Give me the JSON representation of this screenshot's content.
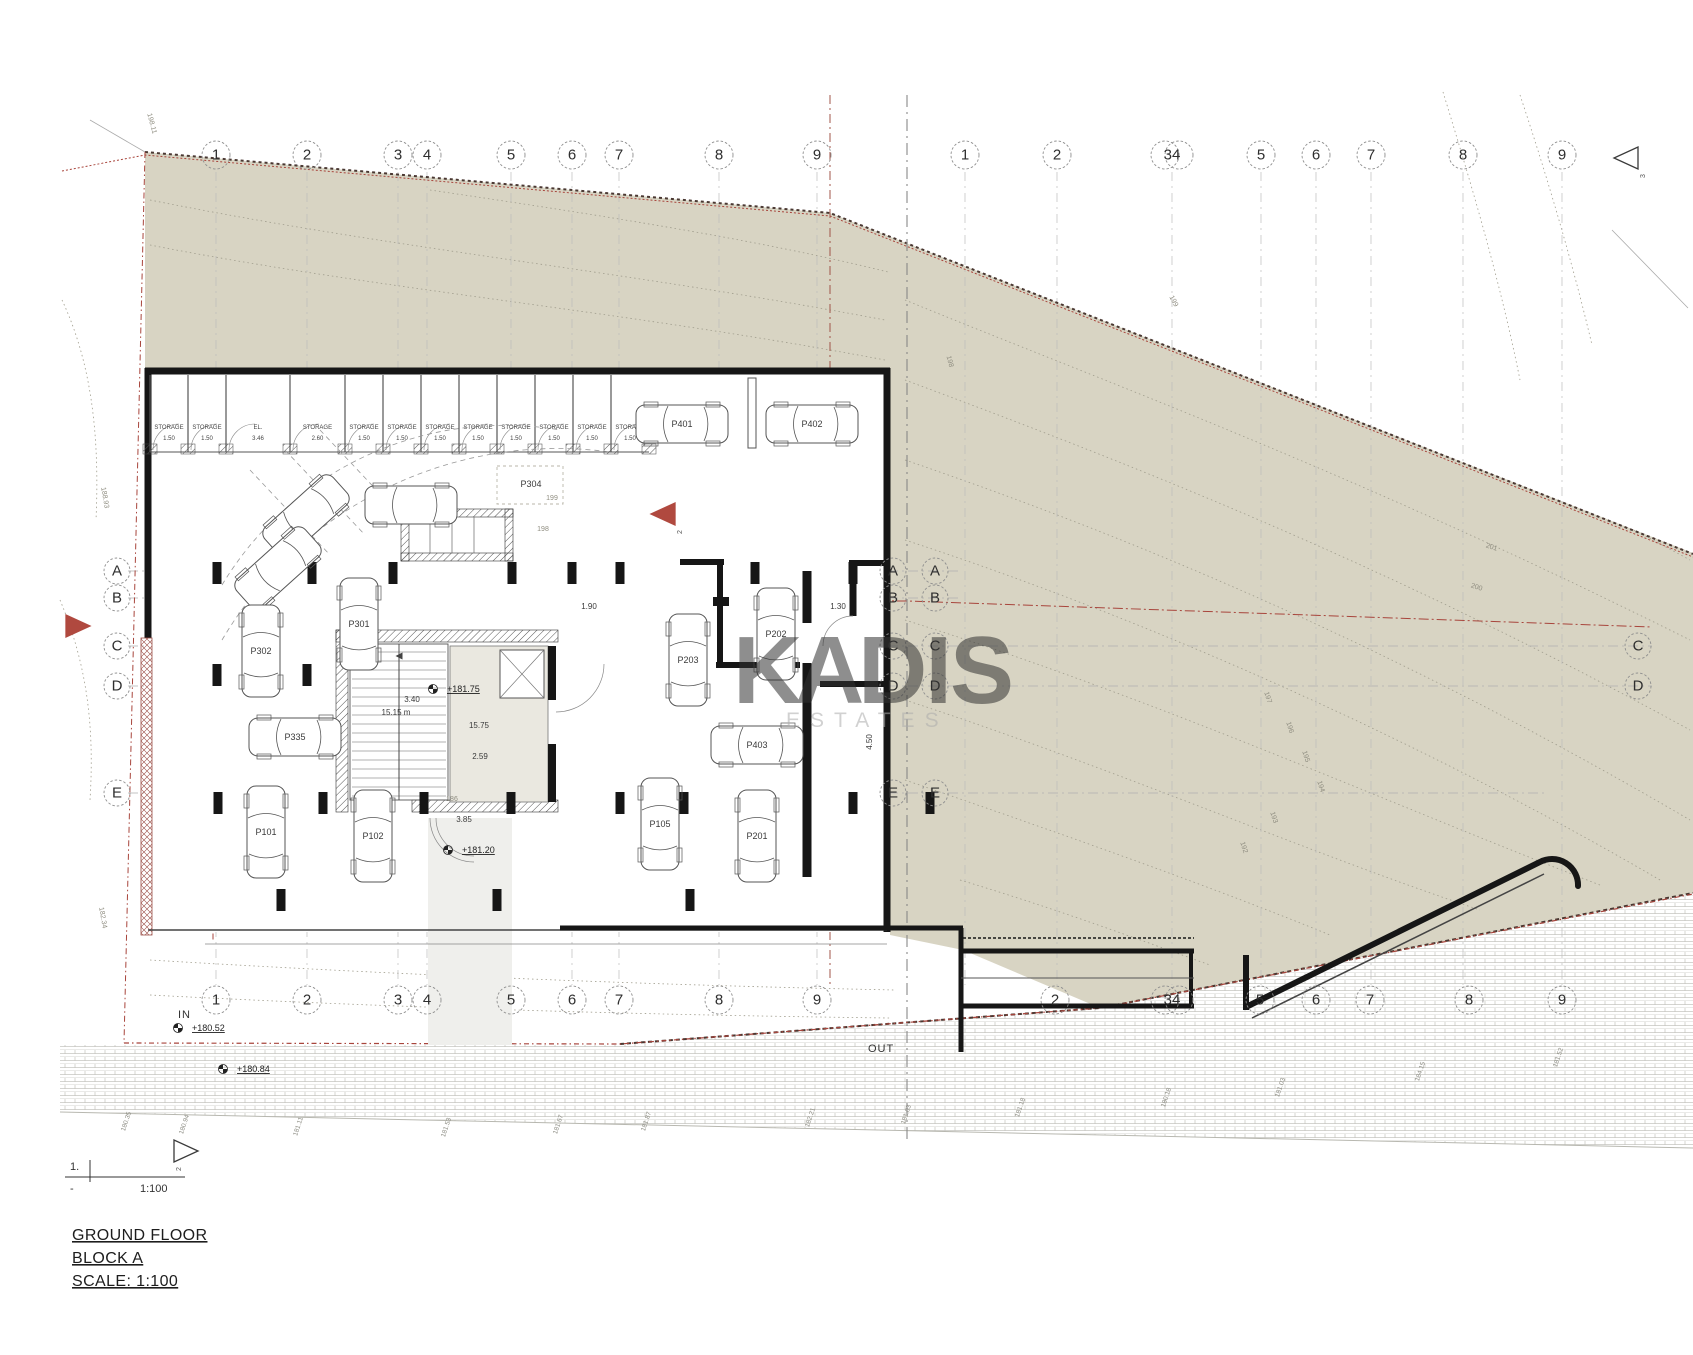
{
  "page": {
    "title_line1": "GROUND FLOOR",
    "title_line2": "BLOCK A",
    "title_line3": "SCALE: 1:100",
    "sheet_no": "1.",
    "sheet_dash": "-",
    "sheet_scale": "1:100"
  },
  "watermark": {
    "k": "K",
    "a": "A",
    "dis": "DIS",
    "subtitle": "ESTATES",
    "gray": "#b5b5b5",
    "tan": "#d7c7a0"
  },
  "flow": {
    "in_label": "IN",
    "out_label": "OUT"
  },
  "colors": {
    "terrain": "#d8d4c3",
    "wall": "#161616",
    "boundary_red": "#a8453c",
    "line": "#555555"
  },
  "grid": {
    "bubble_radius": 14,
    "top_y": 155,
    "bottom_y": 1000,
    "top": [
      {
        "t": "1",
        "x": 216
      },
      {
        "t": "2",
        "x": 307
      },
      {
        "t": "3",
        "x": 398
      },
      {
        "t": "4",
        "x": 427
      },
      {
        "t": "5",
        "x": 511
      },
      {
        "t": "6",
        "x": 572
      },
      {
        "t": "7",
        "x": 619
      },
      {
        "t": "8",
        "x": 719
      },
      {
        "t": "9",
        "x": 817
      },
      {
        "t": "1",
        "x": 965
      },
      {
        "t": "2",
        "x": 1057
      },
      {
        "t": "34",
        "x": 1172,
        "d": true
      },
      {
        "t": "5",
        "x": 1261
      },
      {
        "t": "6",
        "x": 1316
      },
      {
        "t": "7",
        "x": 1371
      },
      {
        "t": "8",
        "x": 1463
      },
      {
        "t": "9",
        "x": 1562
      }
    ],
    "bottom": [
      {
        "t": "1",
        "x": 216
      },
      {
        "t": "2",
        "x": 307
      },
      {
        "t": "3",
        "x": 398
      },
      {
        "t": "4",
        "x": 427
      },
      {
        "t": "5",
        "x": 511
      },
      {
        "t": "6",
        "x": 572
      },
      {
        "t": "7",
        "x": 619
      },
      {
        "t": "8",
        "x": 719
      },
      {
        "t": "9",
        "x": 817
      },
      {
        "t": "2",
        "x": 1055
      },
      {
        "t": "34",
        "x": 1172,
        "d": true
      },
      {
        "t": "5",
        "x": 1260
      },
      {
        "t": "6",
        "x": 1316
      },
      {
        "t": "7",
        "x": 1370
      },
      {
        "t": "8",
        "x": 1469
      },
      {
        "t": "9",
        "x": 1562
      }
    ],
    "letters": [
      {
        "t": "A",
        "x": 117,
        "y": 571
      },
      {
        "t": "B",
        "x": 117,
        "y": 598
      },
      {
        "t": "C",
        "x": 117,
        "y": 646
      },
      {
        "t": "D",
        "x": 117,
        "y": 686
      },
      {
        "t": "E",
        "x": 117,
        "y": 793
      },
      {
        "t": "A",
        "x": 893,
        "y": 571
      },
      {
        "t": "A",
        "x": 935,
        "y": 571
      },
      {
        "t": "B",
        "x": 893,
        "y": 598
      },
      {
        "t": "B",
        "x": 935,
        "y": 598
      },
      {
        "t": "C",
        "x": 893,
        "y": 646
      },
      {
        "t": "C",
        "x": 935,
        "y": 646
      },
      {
        "t": "D",
        "x": 893,
        "y": 686
      },
      {
        "t": "D",
        "x": 935,
        "y": 686
      },
      {
        "t": "E",
        "x": 893,
        "y": 793
      },
      {
        "t": "E",
        "x": 935,
        "y": 793
      },
      {
        "t": "C",
        "x": 1638,
        "y": 646
      },
      {
        "t": "D",
        "x": 1638,
        "y": 686
      }
    ]
  },
  "triangles": [
    {
      "t": "3",
      "x": 1625,
      "y": 158,
      "dir": "left",
      "c": "#3a3a3a",
      "fill": "none"
    },
    {
      "t": "2",
      "x": 662,
      "y": 514,
      "dir": "left",
      "c": "#b0493f",
      "fill": "#b0493f"
    },
    {
      "t": "",
      "x": 79,
      "y": 626,
      "dir": "right",
      "c": "#b0493f",
      "fill": "#b0493f"
    },
    {
      "t": "2",
      "x": 187,
      "y": 1151,
      "dir": "right",
      "c": "#3a3a3a",
      "fill": "none"
    }
  ],
  "cars": [
    {
      "t": "P401",
      "x": 682,
      "y": 424,
      "r": 0
    },
    {
      "t": "P402",
      "x": 812,
      "y": 424,
      "r": 0
    },
    {
      "t": "",
      "x": 411,
      "y": 505,
      "r": 0
    },
    {
      "t": "",
      "x": 306,
      "y": 516,
      "r": -42
    },
    {
      "t": "",
      "x": 278,
      "y": 568,
      "r": -42
    },
    {
      "t": "P301",
      "x": 359,
      "y": 624,
      "r": 90
    },
    {
      "t": "P302",
      "x": 261,
      "y": 651,
      "r": 90
    },
    {
      "t": "P203",
      "x": 688,
      "y": 660,
      "r": 90
    },
    {
      "t": "P202",
      "x": 776,
      "y": 634,
      "r": 90
    },
    {
      "t": "P335",
      "x": 295,
      "y": 737,
      "r": 0
    },
    {
      "t": "P403",
      "x": 757,
      "y": 745,
      "r": 0
    },
    {
      "t": "P101",
      "x": 266,
      "y": 832,
      "r": 90
    },
    {
      "t": "P102",
      "x": 373,
      "y": 836,
      "r": 90
    },
    {
      "t": "P105",
      "x": 660,
      "y": 824,
      "r": 90
    },
    {
      "t": "P201",
      "x": 757,
      "y": 836,
      "r": 90
    }
  ],
  "space_labels": [
    {
      "t": "P304",
      "x": 531,
      "y": 487
    }
  ],
  "storage": {
    "wall_top": 371,
    "wall_bottom": 452,
    "label_y": 429,
    "cells": [
      {
        "x": 150,
        "w": 38,
        "t": "STORAGE",
        "d": "1.50"
      },
      {
        "x": 188,
        "w": 38,
        "t": "STORAGE",
        "d": "1.50"
      },
      {
        "x": 226,
        "w": 64,
        "t": "EL.",
        "d": "3.46"
      },
      {
        "x": 290,
        "w": 55,
        "t": "STORAGE",
        "d": "2.60"
      },
      {
        "x": 345,
        "w": 38,
        "t": "STORAGE",
        "d": "1.50"
      },
      {
        "x": 383,
        "w": 38,
        "t": "STORAGE",
        "d": "1.50"
      },
      {
        "x": 421,
        "w": 38,
        "t": "STORAGE",
        "d": "1.50"
      },
      {
        "x": 459,
        "w": 38,
        "t": "STORAGE",
        "d": "1.50"
      },
      {
        "x": 497,
        "w": 38,
        "t": "STORAGE",
        "d": "1.50"
      },
      {
        "x": 535,
        "w": 38,
        "t": "STORAGE",
        "d": "1.50"
      },
      {
        "x": 573,
        "w": 38,
        "t": "STORAGE",
        "d": "1.50"
      },
      {
        "x": 611,
        "w": 38,
        "t": "STORAGE",
        "d": "1.50"
      }
    ]
  },
  "levels": [
    {
      "t": "+181.75",
      "x": 447,
      "y": 692
    },
    {
      "t": "+181.20",
      "x": 462,
      "y": 853
    },
    {
      "t": "+180.52",
      "x": 192,
      "y": 1031
    },
    {
      "t": "+180.84",
      "x": 237,
      "y": 1072
    }
  ],
  "dims": [
    {
      "t": "15.15 m",
      "x": 396,
      "y": 715
    },
    {
      "t": "3.40",
      "x": 412,
      "y": 702
    },
    {
      "t": "2.59",
      "x": 480,
      "y": 759
    },
    {
      "t": "15.75",
      "x": 479,
      "y": 728
    },
    {
      "t": "1.90",
      "x": 589,
      "y": 609
    },
    {
      "t": "1.30",
      "x": 838,
      "y": 609
    },
    {
      "t": "3.85",
      "x": 464,
      "y": 822
    },
    {
      "t": "4.50",
      "x": 872,
      "y": 742,
      "r": -90
    }
  ],
  "contour_labels": [
    {
      "t": "201",
      "x": 1491,
      "y": 549,
      "r": 18
    },
    {
      "t": "200",
      "x": 1476,
      "y": 589,
      "r": 18
    },
    {
      "t": "199",
      "x": 1172,
      "y": 302,
      "r": 62
    },
    {
      "t": "198",
      "x": 948,
      "y": 362,
      "r": 75
    },
    {
      "t": "197",
      "x": 1266,
      "y": 698,
      "r": 72
    },
    {
      "t": "196",
      "x": 1288,
      "y": 728,
      "r": 72
    },
    {
      "t": "195",
      "x": 1304,
      "y": 757,
      "r": 72
    },
    {
      "t": "194",
      "x": 1319,
      "y": 787,
      "r": 72
    },
    {
      "t": "193",
      "x": 1272,
      "y": 818,
      "r": 72
    },
    {
      "t": "192",
      "x": 1242,
      "y": 848,
      "r": 72
    },
    {
      "t": "199",
      "x": 552,
      "y": 500,
      "r": 0
    },
    {
      "t": "198",
      "x": 543,
      "y": 531,
      "r": 0
    },
    {
      "t": "186",
      "x": 452,
      "y": 801,
      "r": 0
    },
    {
      "t": "198.11",
      "x": 150,
      "y": 124,
      "r": 75
    },
    {
      "t": "188.93",
      "x": 103,
      "y": 498,
      "r": 80
    },
    {
      "t": "182.34",
      "x": 101,
      "y": 918,
      "r": 80
    }
  ],
  "road_labels": [
    {
      "t": "180.35",
      "x": 128,
      "y": 1122
    },
    {
      "t": "180.94",
      "x": 186,
      "y": 1125
    },
    {
      "t": "181.11",
      "x": 300,
      "y": 1127
    },
    {
      "t": "181.53",
      "x": 448,
      "y": 1128
    },
    {
      "t": "181.67",
      "x": 560,
      "y": 1125
    },
    {
      "t": "181.87",
      "x": 648,
      "y": 1122
    },
    {
      "t": "182.21",
      "x": 812,
      "y": 1118
    },
    {
      "t": "181.03",
      "x": 908,
      "y": 1115
    },
    {
      "t": "181.18",
      "x": 1022,
      "y": 1108
    },
    {
      "t": "180.18",
      "x": 1168,
      "y": 1098
    },
    {
      "t": "181.03",
      "x": 1282,
      "y": 1088
    },
    {
      "t": "184.15",
      "x": 1422,
      "y": 1072
    },
    {
      "t": "181.52",
      "x": 1560,
      "y": 1058
    }
  ]
}
